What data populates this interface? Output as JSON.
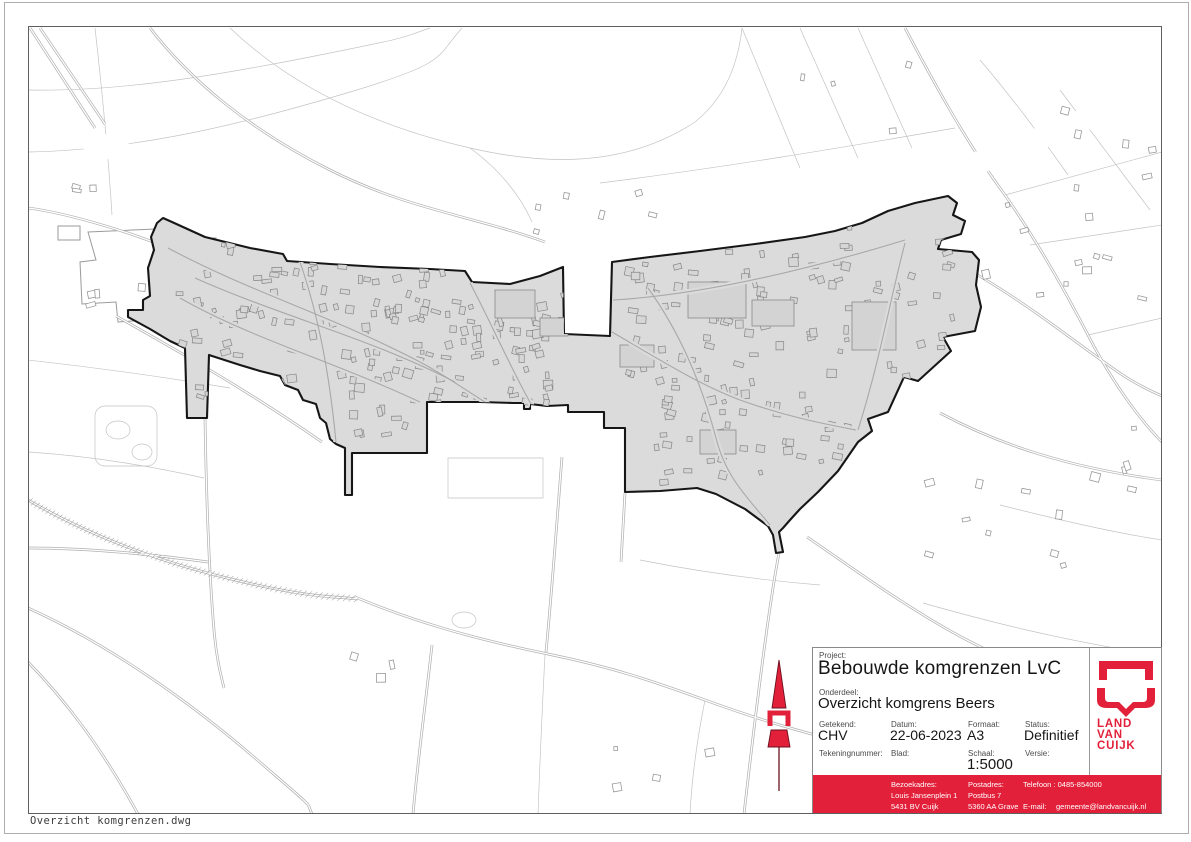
{
  "sheet": {
    "filename_note": "Overzicht komgrenzen.dwg"
  },
  "title_block": {
    "project_label": "Project:",
    "project_value": "Bebouwde komgrenzen LvC",
    "onderdeel_label": "Onderdeel:",
    "onderdeel_value": "Overzicht komgrens Beers",
    "fields": [
      {
        "label": "Getekend:",
        "value": "CHV"
      },
      {
        "label": "Datum:",
        "value": "22-06-2023"
      },
      {
        "label": "Formaat:",
        "value": "A3"
      },
      {
        "label": "Status:",
        "value": "Definitief"
      },
      {
        "label": "Tekeningnummer:",
        "value": ""
      },
      {
        "label": "Blad:",
        "value": ""
      },
      {
        "label": "Schaal:",
        "value": "1:5000"
      },
      {
        "label": "Versie:",
        "value": ""
      }
    ],
    "contact": {
      "bezoekadres_label": "Bezoekadres:",
      "bezoekadres_line1": "Louis Jansenplein 1",
      "bezoekadres_line2": "5431 BV Cuijk",
      "postadres_label": "Postadres:",
      "postadres_line1": "Postbus 7",
      "postadres_line2": "5360 AA Grave",
      "telefoon": "Telefoon : 0485-854000",
      "email_label": "E-mail:",
      "email_value": "gemeente@landvancuijk.nl"
    },
    "logo": {
      "line1": "LAND",
      "line2": "VAN",
      "line3": "CUIJK"
    }
  },
  "colors": {
    "brand_red": "#e2203a",
    "builtup_fill": "#dbdbdb",
    "boundary_black": "#161616",
    "map_line_gray": "#b0b0b0"
  }
}
